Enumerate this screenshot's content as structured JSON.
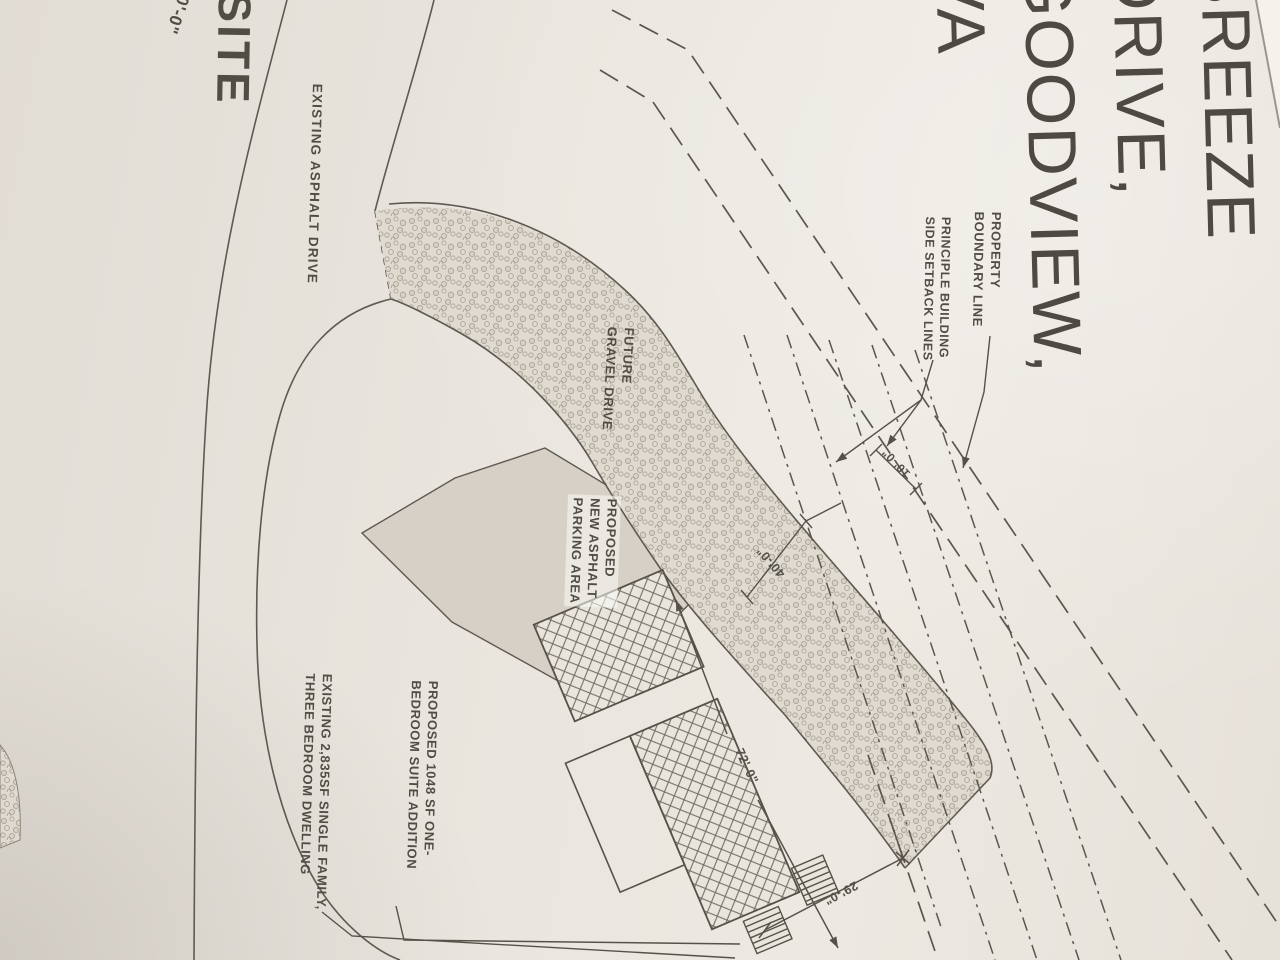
{
  "drawing": {
    "site_label": "SITE",
    "scale_fragment": "20'-0\"",
    "street_title": "BREEZE DRIVE, GOODVIEW, VA",
    "labels": {
      "existing_asphalt_drive": "EXISTING ASPHALT DRIVE",
      "future_gravel_drive": "FUTURE\nGRAVEL DRIVE",
      "property_boundary_line": "PROPERTY\nBOUNDARY LINE",
      "setback_lines": "PRINCIPLE BUILDING\nSIDE SETBACK LINES",
      "parking_area": "PROPOSED\nNEW ASPHALT\nPARKING AREA",
      "suite_addition": "PROPOSED 1048 SF ONE-\nBEDROOM SUITE ADDITION",
      "dwelling": "EXISTING 2,835SF SINGLE FAMILY,\nTHREE BEDROOM DWELLING"
    },
    "dimensions": {
      "side_setback_offset": "10'-0\"",
      "building_setback_offset": "40'-0\"",
      "building_length": "72'-0\"",
      "rear_clearance": "29'-0\""
    },
    "colors": {
      "paper": "#e9e5de",
      "ink": "#5b574e",
      "parking_fill": "#d6d0c6",
      "gravel_fill": "#e0dbd1"
    }
  }
}
